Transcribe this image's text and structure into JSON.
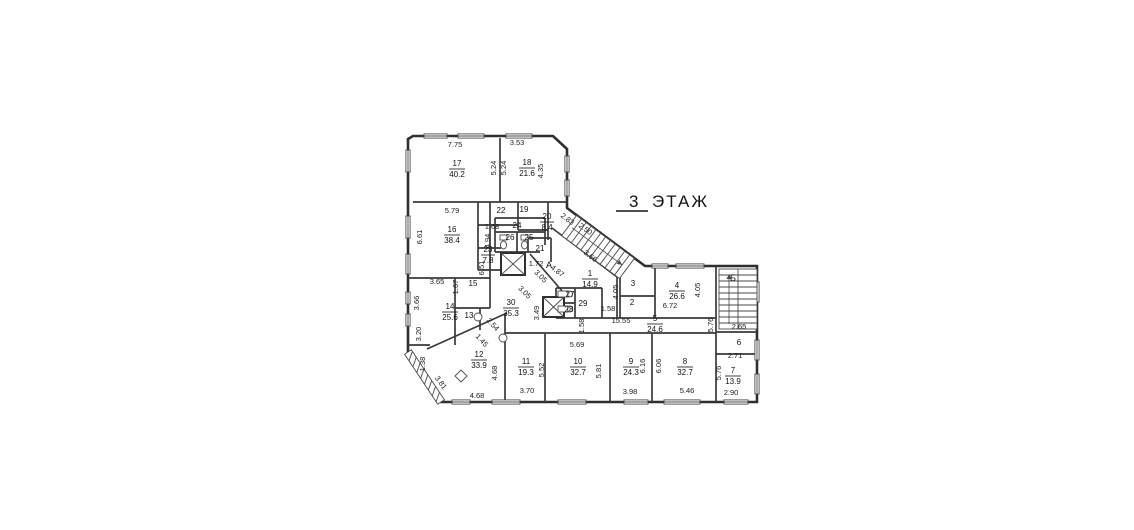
{
  "title": {
    "number": "3",
    "word": "ЭТАЖ"
  },
  "stairwells": {
    "a": "А",
    "b": "Б"
  },
  "rooms": {
    "r1": {
      "num": "1",
      "area": "14.9"
    },
    "r2": {
      "num": "2"
    },
    "r3": {
      "num": "3"
    },
    "r4": {
      "num": "4",
      "area": "26.6"
    },
    "r5": {
      "num": "5",
      "area": "24.6"
    },
    "r6": {
      "num": "6"
    },
    "r7": {
      "num": "7",
      "area": "13.9"
    },
    "r8": {
      "num": "8",
      "area": "32.7"
    },
    "r9": {
      "num": "9",
      "area": "24.3"
    },
    "r10": {
      "num": "10",
      "area": "32.7"
    },
    "r11": {
      "num": "11",
      "area": "19.3"
    },
    "r12": {
      "num": "12",
      "area": "33.9"
    },
    "r13": {
      "num": "13"
    },
    "r14": {
      "num": "14",
      "area": "25.6"
    },
    "r15": {
      "num": "15"
    },
    "r16": {
      "num": "16",
      "area": "38.4"
    },
    "r17": {
      "num": "17",
      "area": "40.2"
    },
    "r18": {
      "num": "18",
      "area": "21.6"
    },
    "r19": {
      "num": "19"
    },
    "r20": {
      "num": "20",
      "area": "8.4"
    },
    "r21": {
      "num": "21"
    },
    "r22": {
      "num": "22"
    },
    "r23": {
      "num": "23",
      "area": "7.8"
    },
    "r24": {
      "num": "24"
    },
    "r25": {
      "num": "25"
    },
    "r26": {
      "num": "26"
    },
    "r27": {
      "num": "27"
    },
    "r28": {
      "num": "28"
    },
    "r29": {
      "num": "29"
    },
    "r30": {
      "num": "30",
      "area": "35.3"
    }
  },
  "dims": {
    "d1": "7.75",
    "d2": "3.53",
    "d3": "5.24",
    "d4": "5.24",
    "d5": "4.35",
    "d6": "5.79",
    "d7": "6.61",
    "d8": "1.68",
    "d9": "4.94",
    "d10": "6.51",
    "d11": "1.72",
    "d12": "2.83",
    "d13": "2.50",
    "d14": "3.66",
    "d15": "4.87",
    "d16": "3.05",
    "d17": "3.05",
    "d18": "3.49",
    "d19": "3.65",
    "d20": "1.67",
    "d21": "3.66",
    "d22": "3.20",
    "d23": "2.54",
    "d24": "1.45",
    "d25": "1.38",
    "d26": "3.81",
    "d27": "4.68",
    "d28": "4.68",
    "d29": "3.70",
    "d30": "5.52",
    "d31": "5.69",
    "d32": "5.81",
    "d33": "3.98",
    "d34": "6.16",
    "d35": "6.06",
    "d36": "5.46",
    "d37": "5.76",
    "d38": "2.90",
    "d39": "2.71",
    "d40": "2.65",
    "d41": "5.76",
    "d42": "15.55",
    "d43": "1.58",
    "d44": "1.58",
    "d45": "4.05",
    "d46": "4.05",
    "d47": "6.72"
  }
}
